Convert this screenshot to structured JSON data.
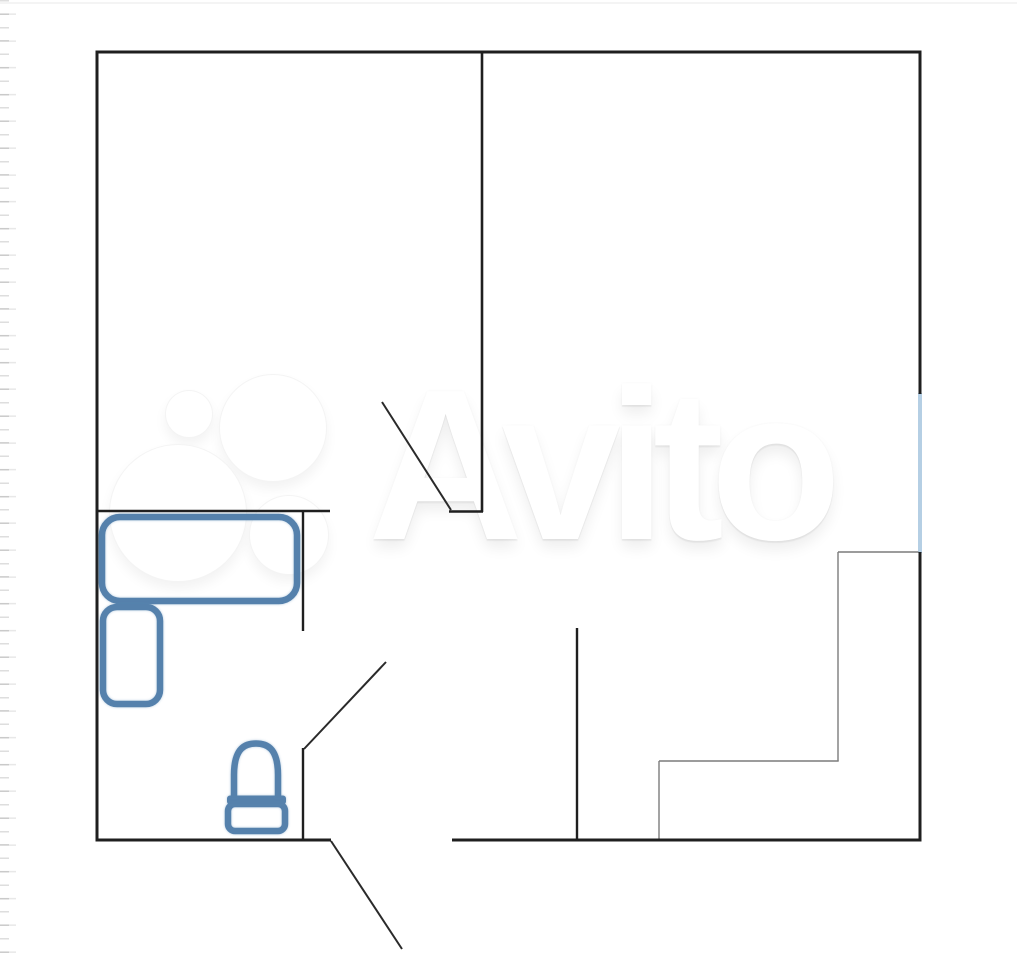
{
  "image": {
    "width": 1017,
    "height": 960,
    "kind": "apartment-floor-plan-photo"
  },
  "watermark": {
    "text": "Avito",
    "logo_circles": [
      {
        "name": "avito-logo-circle-small",
        "cx": 188,
        "cy": 413,
        "r": 23
      },
      {
        "name": "avito-logo-circle-large",
        "cx": 272,
        "cy": 427,
        "r": 53
      },
      {
        "name": "avito-logo-circle-xlarge",
        "cx": 177,
        "cy": 512,
        "r": 68
      },
      {
        "name": "avito-logo-circle-medium",
        "cx": 288,
        "cy": 534,
        "r": 39
      }
    ]
  },
  "colors": {
    "wall": "#1f1f1f",
    "door_leaf": "#2a2a2a",
    "furniture_outline": "#5581ac",
    "window": "#b5cfe4",
    "thin_line": "#7c7c7c",
    "background": "#ffffff"
  },
  "floorplan": {
    "walls": [
      {
        "name": "wall-outer-top",
        "x1": 95.5,
        "y1": 52,
        "x2": 921,
        "y2": 52,
        "w": 3
      },
      {
        "name": "wall-outer-left",
        "x1": 97,
        "y1": 50.5,
        "x2": 97,
        "y2": 841.5,
        "w": 3
      },
      {
        "name": "wall-outer-right-upper",
        "x1": 920,
        "y1": 50.5,
        "x2": 920,
        "y2": 394,
        "w": 3
      },
      {
        "name": "wall-outer-right-lower",
        "x1": 920,
        "y1": 552,
        "x2": 920,
        "y2": 841.5,
        "w": 3
      },
      {
        "name": "wall-outer-bottom-left",
        "x1": 95.5,
        "y1": 840,
        "x2": 331,
        "y2": 840,
        "w": 3
      },
      {
        "name": "wall-outer-bottom-right",
        "x1": 452,
        "y1": 840,
        "x2": 921.5,
        "y2": 840,
        "w": 3
      },
      {
        "name": "wall-rooms-divider",
        "x1": 482,
        "y1": 52,
        "x2": 482,
        "y2": 512,
        "w": 2.6
      },
      {
        "name": "wall-divider-stub",
        "x1": 449,
        "y1": 511.5,
        "x2": 483,
        "y2": 511.5,
        "w": 2.4
      },
      {
        "name": "wall-bedroom-south",
        "x1": 97,
        "y1": 511,
        "x2": 330,
        "y2": 511,
        "w": 2.6
      },
      {
        "name": "wall-bathroom-east-upper",
        "x1": 303,
        "y1": 511,
        "x2": 303,
        "y2": 631,
        "w": 2.4
      },
      {
        "name": "wall-bathroom-east-lower",
        "x1": 303,
        "y1": 748,
        "x2": 303,
        "y2": 841,
        "w": 2.4
      },
      {
        "name": "wall-hallway-east",
        "x1": 577,
        "y1": 628,
        "x2": 577,
        "y2": 841,
        "w": 2.4
      }
    ],
    "door_leaves": [
      {
        "name": "door-leaf-living-room",
        "x1": 382,
        "y1": 402,
        "x2": 451,
        "y2": 510,
        "w": 2
      },
      {
        "name": "door-leaf-bathroom",
        "x1": 386,
        "y1": 662,
        "x2": 304,
        "y2": 749,
        "w": 2
      },
      {
        "name": "door-leaf-entrance",
        "x1": 331,
        "y1": 841,
        "x2": 402,
        "y2": 949,
        "w": 2
      }
    ],
    "window_line": {
      "name": "window-right-wall",
      "x1": 920,
      "y1": 393,
      "x2": 920,
      "y2": 553,
      "w": 4
    },
    "thin_lines": [
      {
        "name": "step-line-top",
        "x1": 838,
        "y1": 552,
        "x2": 918.5,
        "y2": 552,
        "w": 1.4
      },
      {
        "name": "step-line-right",
        "x1": 838,
        "y1": 552,
        "x2": 838,
        "y2": 761,
        "w": 1.4
      },
      {
        "name": "step-line-bottom",
        "x1": 659,
        "y1": 761,
        "x2": 838.7,
        "y2": 761,
        "w": 1.4
      },
      {
        "name": "step-line-left",
        "x1": 659,
        "y1": 761,
        "x2": 659,
        "y2": 839,
        "w": 1.4
      }
    ],
    "furniture": {
      "rects": [
        {
          "name": "bed",
          "x": 102,
          "y": 517,
          "w": 195,
          "h": 84,
          "rx": 18
        },
        {
          "name": "nightstand",
          "x": 103,
          "y": 607,
          "w": 57,
          "h": 97,
          "rx": 14
        },
        {
          "name": "toilet-tank",
          "x": 228,
          "y": 804,
          "w": 57,
          "h": 27,
          "rx": 7
        }
      ],
      "bars": [
        {
          "name": "toilet-seat-bar",
          "x": 227,
          "y": 795.5,
          "w": 59,
          "h": 9,
          "rx": 3
        }
      ],
      "paths": [
        {
          "name": "toilet-bowl",
          "d": "M 234 798 L 234 775 C 234 747 246 743.5 256 743.5 C 266 743.5 278 747 278 775 L 278 798"
        }
      ]
    }
  }
}
